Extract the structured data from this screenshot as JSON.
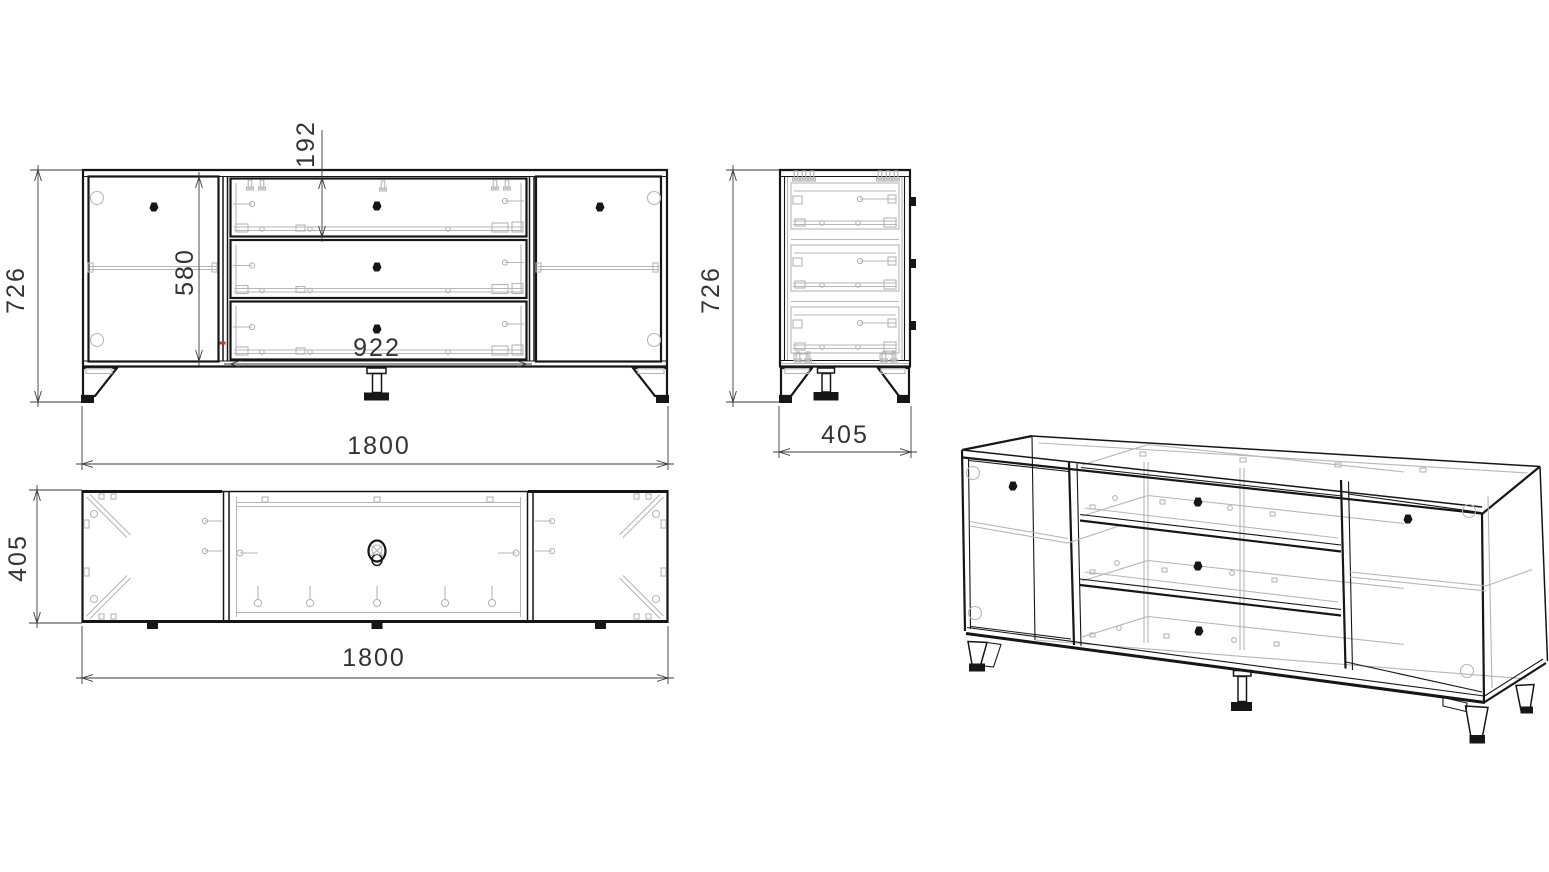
{
  "dimensions": {
    "front_height": "726",
    "front_door_height": "580",
    "front_drawer_height": "192",
    "front_drawer_bay_width": "922",
    "front_width": "1800",
    "side_height": "726",
    "side_depth": "405",
    "top_depth": "405",
    "top_width": "1800"
  },
  "colors": {
    "line": "#161616",
    "hardware": "#b6b6b6",
    "dimension": "#3a3a3a",
    "accent_red": "#c0392b",
    "background": "#ffffff"
  }
}
